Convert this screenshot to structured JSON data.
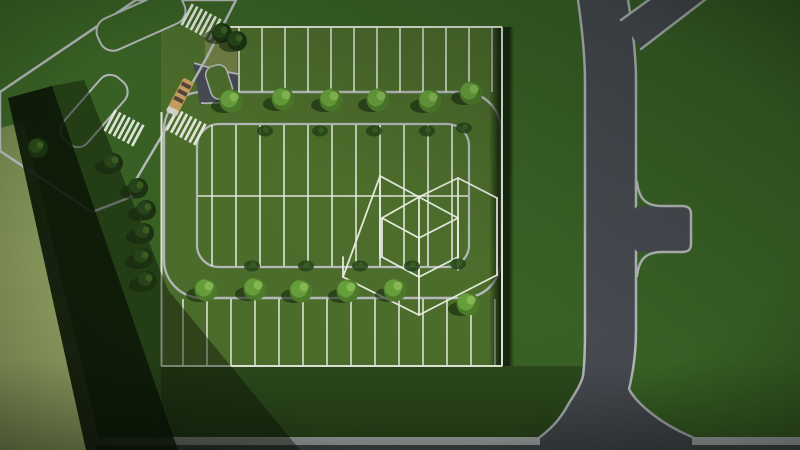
{
  "scene": {
    "description": "Aerial top-down 3D render of a subdivision site plan: a parking-loop street inside a square parcel with surveyed lot lines, street trees, a diagonal boulevard with crosswalks and a school bus at top-left, an arterial road network on the right, and a white wireframe building massing over the center-right lots",
    "colors": {
      "grass_base": "#3a6325",
      "grass_lot": "#4d6e2c",
      "grass_under": "#2c4a1c",
      "lot_dirt": "#78834a",
      "olive_a": "#76884e",
      "olive_b": "#9aa968",
      "asphalt": "#484c53",
      "curb": "#b7bbbd",
      "line_white": "#edf2e7",
      "shadow_deep": "#0a1405",
      "tree_shadow": "#16270d",
      "tree_mid": "#4e7c2b",
      "tree_bright": "#68a03c",
      "tree_light": "#86bb52",
      "tree_dark": "#1c3212",
      "tree_dark2": "#27451a",
      "tree_dark3": "#3a5f22",
      "bus_body": "#c8a162",
      "bus_stripe": "#55483a",
      "bus_front": "#d6d6cf"
    },
    "lots": {
      "top_strip": {
        "y1": 27,
        "y2": 92,
        "x": [
          239,
          262,
          285,
          308,
          331,
          354,
          377,
          400,
          423,
          446,
          469,
          492
        ]
      },
      "island": {
        "y1": 125,
        "y2": 266,
        "x": [
          212,
          236,
          260,
          284,
          308,
          332,
          356,
          380,
          404,
          428,
          452
        ],
        "midline": {
          "y": 196,
          "x1": 198,
          "x2": 468
        }
      },
      "bottom_strip": {
        "y1": 299,
        "y2": 366,
        "x": [
          183,
          207,
          231,
          255,
          279,
          303,
          327,
          351,
          375,
          399,
          423,
          447,
          471,
          495
        ]
      }
    },
    "trees": {
      "bright": [
        [
          231,
          101
        ],
        [
          283,
          99
        ],
        [
          331,
          100
        ],
        [
          378,
          100
        ],
        [
          430,
          101
        ],
        [
          471,
          93
        ],
        [
          206,
          290
        ],
        [
          255,
          289
        ],
        [
          301,
          291
        ],
        [
          348,
          291
        ],
        [
          395,
          290
        ],
        [
          468,
          304
        ]
      ],
      "dark": [
        [
          222,
          33
        ],
        [
          237,
          41
        ],
        [
          113,
          163
        ],
        [
          138,
          188
        ],
        [
          146,
          210
        ],
        [
          144,
          233
        ],
        [
          143,
          258
        ],
        [
          147,
          281
        ],
        [
          38,
          148
        ]
      ],
      "bushes": [
        [
          265,
          131
        ],
        [
          320,
          131
        ],
        [
          374,
          131
        ],
        [
          427,
          131
        ],
        [
          464,
          128
        ],
        [
          252,
          266
        ],
        [
          306,
          266
        ],
        [
          360,
          266
        ],
        [
          412,
          266
        ],
        [
          458,
          264
        ]
      ]
    },
    "crosswalks": [
      {
        "x": 201,
        "y": 22,
        "angle": 28
      },
      {
        "x": 186,
        "y": 127,
        "angle": 28
      },
      {
        "x": 124,
        "y": 128,
        "angle": 28
      }
    ],
    "bus": {
      "x": 180,
      "y": 97,
      "angle": 28
    },
    "wireframe": {
      "segments": [
        [
          343,
          277,
          380,
          176
        ],
        [
          380,
          176,
          419,
          197
        ],
        [
          419,
          197,
          458,
          178
        ],
        [
          458,
          178,
          497,
          198
        ],
        [
          497,
          198,
          497,
          275
        ],
        [
          343,
          277,
          419,
          315
        ],
        [
          419,
          315,
          497,
          275
        ],
        [
          380,
          176,
          380,
          258
        ],
        [
          419,
          197,
          419,
          315
        ],
        [
          458,
          178,
          458,
          270
        ],
        [
          343,
          257,
          343,
          277
        ],
        [
          419,
          197,
          458,
          218
        ],
        [
          458,
          218,
          419,
          238
        ],
        [
          419,
          238,
          382,
          218
        ],
        [
          382,
          218,
          419,
          197
        ],
        [
          382,
          218,
          382,
          257
        ],
        [
          419,
          238,
          419,
          277
        ],
        [
          458,
          218,
          458,
          257
        ],
        [
          382,
          257,
          419,
          277
        ],
        [
          419,
          277,
          458,
          257
        ]
      ]
    }
  }
}
